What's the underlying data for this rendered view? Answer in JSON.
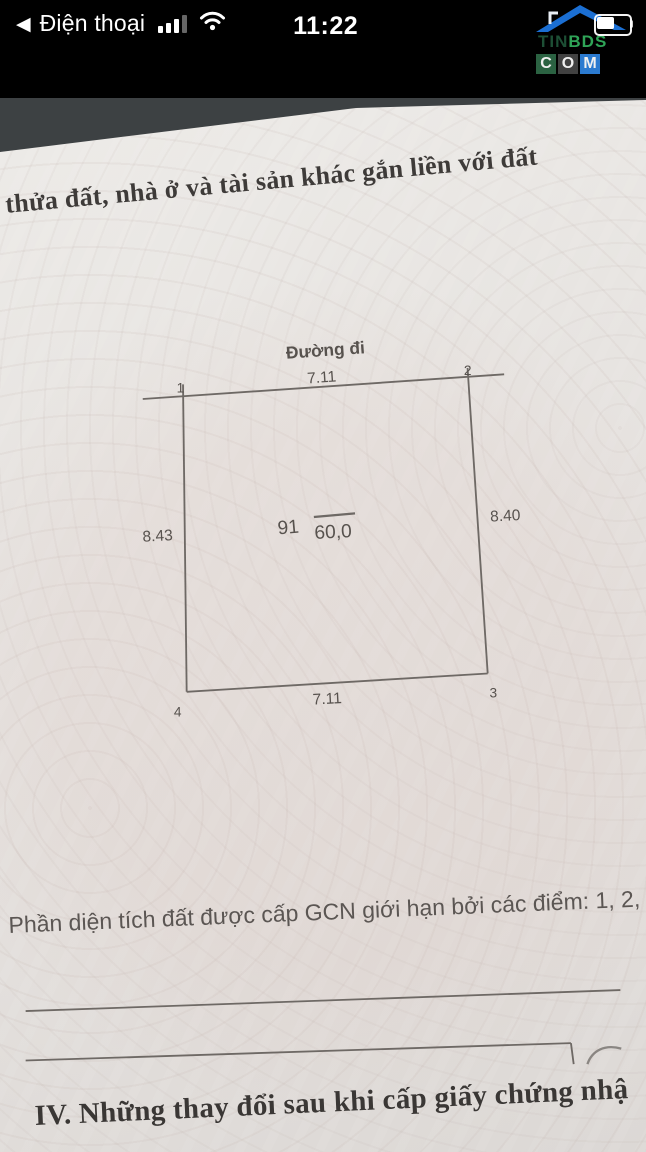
{
  "status_bar": {
    "back_icon": "◀",
    "back_label": "Điện thoại",
    "time": "11:22"
  },
  "watermark": {
    "tin": "TIN",
    "bds": "BDS",
    "com": [
      "C",
      "O",
      "M"
    ]
  },
  "document": {
    "header_line": "thửa đất, nhà ở và tài sản khác gắn liền với đất",
    "caption": "Phần diện tích đất được cấp GCN giới hạn bởi các điểm: 1, 2, 3, 4",
    "section_heading": "IV. Những thay đổi sau khi cấp giấy chứng nhậ",
    "diagram": {
      "road_label": "Đường đi",
      "edge_top": "7.11",
      "edge_bottom": "7.11",
      "edge_left": "8.43",
      "edge_right": "8.40",
      "parcel_number": "91",
      "area_value": "60,0",
      "corner_1": "1",
      "corner_2": "2",
      "corner_3": "3",
      "corner_4": "4"
    }
  },
  "colors": {
    "brand_roof_blue": "#1b6fd3",
    "brand_green": "#2fa457",
    "com_c_bg": "#2b6242",
    "com_o_bg": "#414141",
    "com_m_bg": "#2b7ad0",
    "red_mark": "#b65450",
    "paper": "#e6e3e0"
  }
}
